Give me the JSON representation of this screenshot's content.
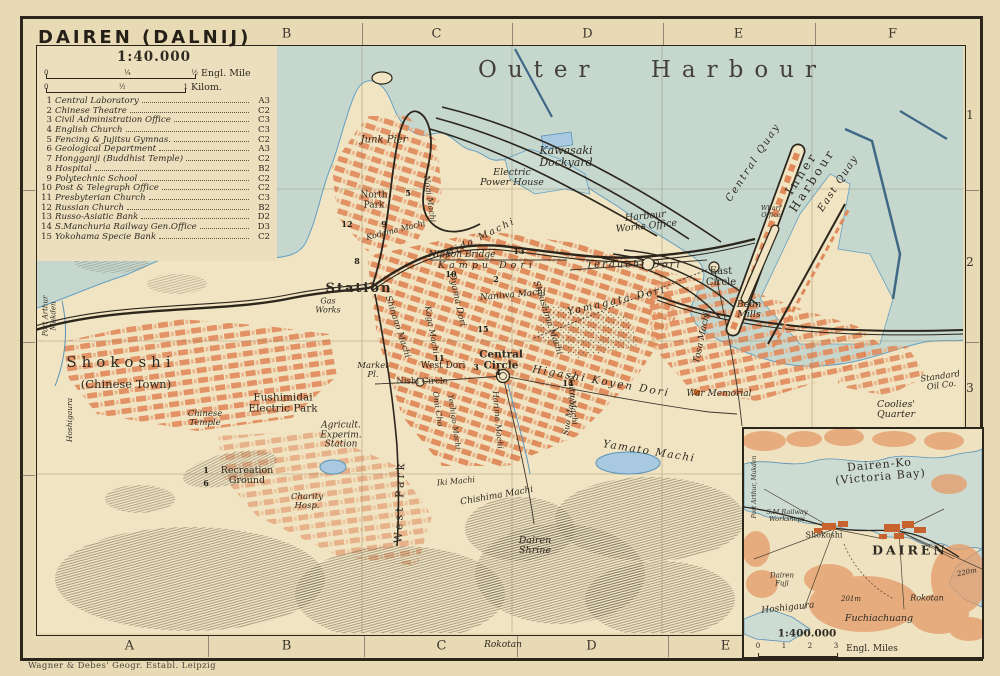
{
  "colors": {
    "paper": "#e8dab5",
    "land": "#f0e4c2",
    "sea": "#ccdcd3",
    "block_orange": "#e0895a",
    "railway_ink": "#2b251c",
    "water_line": "#5b93ba",
    "text_ink": "#2f2a22",
    "hill_orange": "#e49a68"
  },
  "title_block": {
    "title": "DAIREN (DALNIJ)",
    "scale": "1:40.000",
    "mile_bar": {
      "ticks": [
        "0",
        "¼",
        "½"
      ],
      "unit": "Engl. Mile"
    },
    "km_bar": {
      "ticks": [
        "0",
        "½",
        "1"
      ],
      "unit": "Kilom."
    }
  },
  "legend": {
    "items": [
      {
        "num": "1",
        "name": "Central Laboratory",
        "ref": "A3"
      },
      {
        "num": "2",
        "name": "Chinese Theatre",
        "ref": "C2"
      },
      {
        "num": "3",
        "name": "Civil Administration Office",
        "ref": "C3"
      },
      {
        "num": "4",
        "name": "English Church",
        "ref": "C3"
      },
      {
        "num": "5",
        "name": "Fencing & Jujitsu Gymnas.",
        "ref": "C2"
      },
      {
        "num": "6",
        "name": "Geological Department",
        "ref": "A3"
      },
      {
        "num": "7",
        "name": "Hongganji (Buddhist Temple)",
        "ref": "C2"
      },
      {
        "num": "8",
        "name": "Hospital",
        "ref": "B2"
      },
      {
        "num": "9",
        "name": "Polytechnic School",
        "ref": "C2"
      },
      {
        "num": "10",
        "name": "Post & Telegraph Office",
        "ref": "C2"
      },
      {
        "num": "11",
        "name": "Presbyterian Church",
        "ref": "C3"
      },
      {
        "num": "12",
        "name": "Russian Church",
        "ref": "B2"
      },
      {
        "num": "13",
        "name": "Russo-Asiatic Bank",
        "ref": "D2"
      },
      {
        "num": "14",
        "name": "S.Manchuria Railway Gen.Office",
        "ref": "D3"
      },
      {
        "num": "15",
        "name": "Yokohama Specie Bank",
        "ref": "C2"
      }
    ]
  },
  "grid": {
    "top": [
      "B",
      "C",
      "D",
      "E",
      "F"
    ],
    "bottom": [
      "A",
      "B",
      "C",
      "D",
      "E"
    ],
    "left": [
      "2",
      "3",
      "4"
    ],
    "right": [
      "1",
      "2",
      "3"
    ]
  },
  "map": {
    "labels": {
      "outer_harbour": "Outer Harbour",
      "junk_pier": "Junk Pier",
      "north_park": "North\nPark",
      "kodama_machi": "Kodama Machi",
      "nogi_machi": "Nogi Machi",
      "hida_machi": "Hida Machi",
      "nippon_bridge": "Nippon Bridge",
      "kampu_dori": "Kampu Dori",
      "station": "Station",
      "gas_works": "Gas\nWorks",
      "port_arthur_mukden": "Port Arthur\nMukden",
      "hoshigaura": "Hoshigaura",
      "shokoshi": "Shokoshi",
      "chinese_town": "(Chinese Town)",
      "chinese_temple": "Chinese\nTemple",
      "fushimidai_electric_park": "Fushimidai\nElectric Park",
      "agricult_experim_station": "Agricult.\nExperim.\nStation",
      "recreation_ground": "Recreation\nGround",
      "charity_hosp": "Charity\nHosp.",
      "west_park": "West Park",
      "market_pl": "Market\nPl.",
      "nishi_circle": "Nishi Circle",
      "west_dori": "West Dori",
      "central_circle": "Central\nCircle",
      "oyama_dori": "Oyama Dori",
      "kaga_machi": "Kaga Machi",
      "shinano_machi": "Shinano Machi",
      "naniwa_machi": "Naniwa Machi",
      "shikishima_machi": "Shikishima Machi",
      "yamagata_dori": "Yamagata Dori",
      "terauchi_dori": "Terauchi Dori",
      "east_circle": "East\nCircle",
      "bean_mills": "Bean\nMills",
      "higashi_koyen_dori": "Higashi Koyen Dori",
      "tosa_machi": "Tosa Machi",
      "war_memorial": "War Memorial",
      "suo_machi": "Suo Machi",
      "yamato_machi": "Yamato Machi",
      "chishima_machi": "Chishima Machi",
      "dairen_shrine": "Dairen\nShrine",
      "iki_machi": "Iki Machi",
      "omi_cho": "Omi Cho",
      "yechigo_machi": "Yechigo Machi",
      "harima_machi": "Harima Machi",
      "naito_machi": "Naito Machi",
      "kawasaki_dockyard": "Kawasaki\nDockyard",
      "electric_power_house": "Electric\nPower House",
      "harbour_works_office": "Harbour\nWorks Office",
      "central_quay": "Central Quay",
      "inner_harbour": "Inner\nHarbour",
      "east_quay": "East Quay",
      "wharf_office": "Wharf\nOffice",
      "standard_oil": "Standard\nOil Co.",
      "coolies_quarter": "Coolies'\nQuarter",
      "rokotan": "Rokotan"
    },
    "markers": {
      "m1": "1",
      "m2": "2",
      "m3": "3",
      "m4": "4",
      "m5": "5",
      "m6": "6",
      "m8": "8",
      "m9": "9",
      "m10": "10",
      "m11": "11",
      "m12": "12",
      "m13": "13",
      "m14": "14",
      "m15": "15"
    }
  },
  "inset": {
    "labels": {
      "victoria_bay": "Dairen-Ko (Victoria Bay)",
      "port_arthur_mukden": "Port Arthur, Mukden",
      "smr_workshops": "S.M.Railway\nWorkshops",
      "shokoshi": "Shokoshi",
      "dairen": "DAIREN",
      "dairen_fuji": "Dairen\nFuji",
      "hoshigaura": "Hoshigaura",
      "elev_201": "201m",
      "rokotan": "Rokotan",
      "fuchiachuang": "Fuchiachuang",
      "elev_220": "220m"
    },
    "scale": "1:400.000",
    "bar_ticks": [
      "0",
      "1",
      "2",
      "3"
    ],
    "bar_unit": "Engl. Miles"
  },
  "credit": "Wagner & Debes' Geogr. Establ. Leipzig"
}
